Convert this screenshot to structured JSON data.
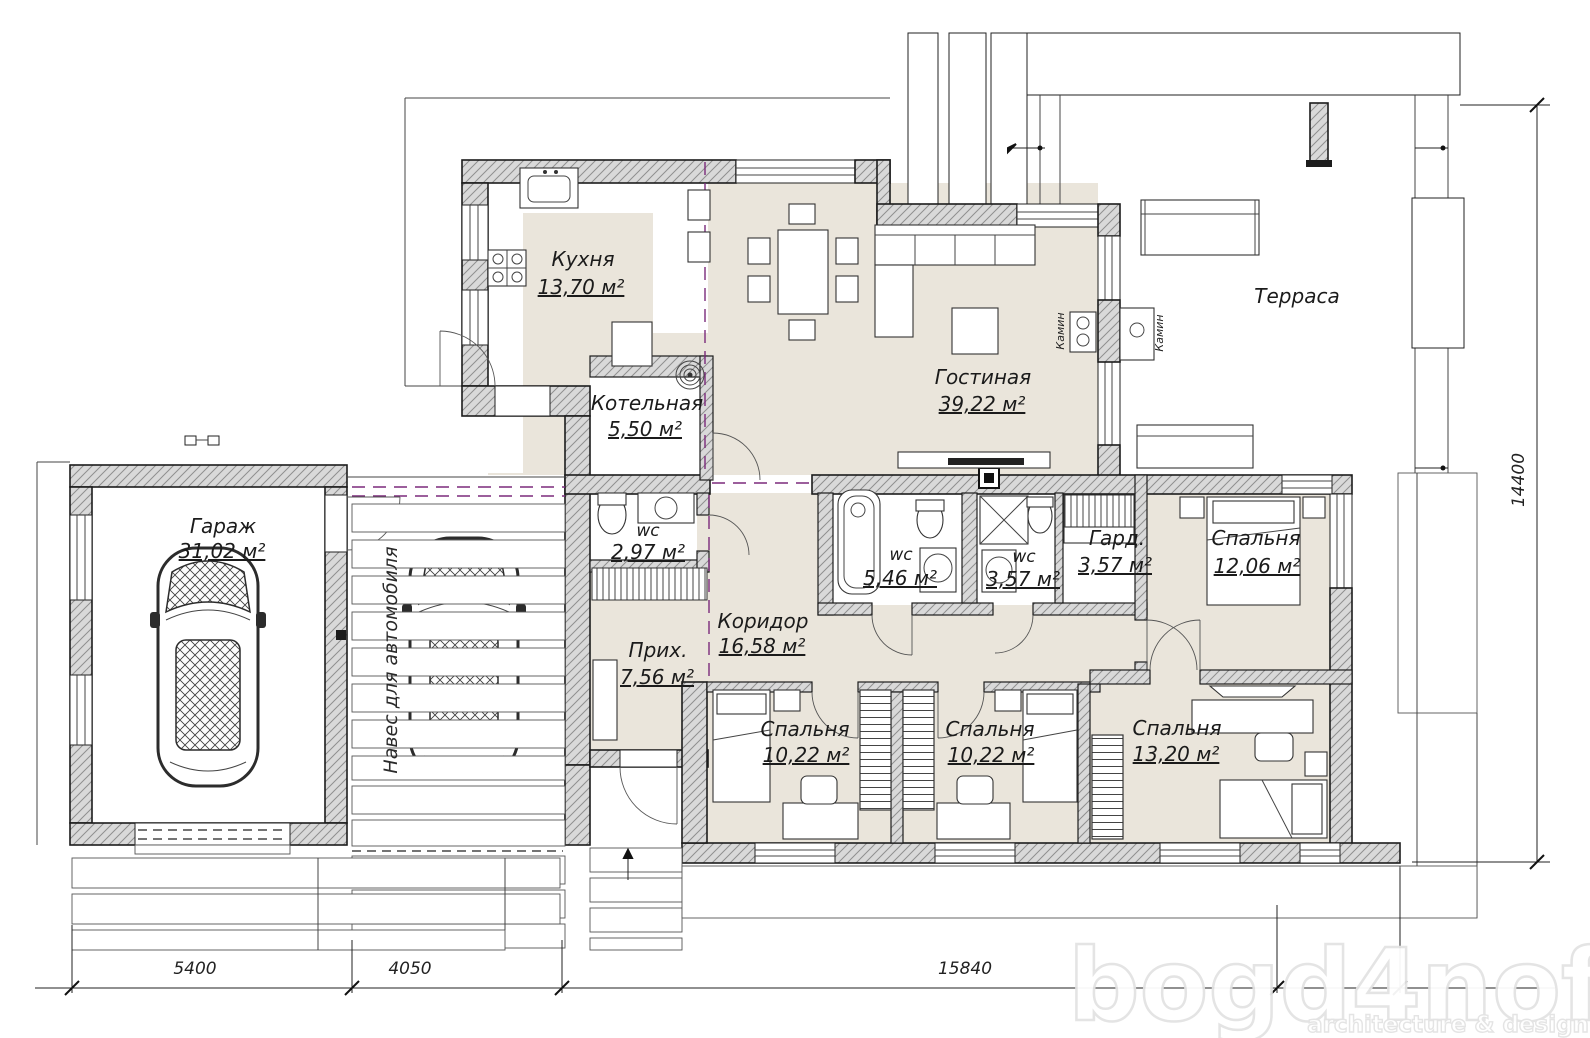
{
  "rooms": {
    "kitchen": {
      "name": "Кухня",
      "area": "13,70 м²"
    },
    "living": {
      "name": "Гостиная",
      "area": "39,22 м²"
    },
    "boiler": {
      "name": "Котельная",
      "area": "5,50 м²"
    },
    "terrace": {
      "name": "Терраса"
    },
    "garage": {
      "name": "Гараж",
      "area": "31,02 м²"
    },
    "wc_entry": {
      "name": "wc",
      "area": "2,97 м²"
    },
    "hall": {
      "name": "Прих.",
      "area": "7,56 м²"
    },
    "corridor": {
      "name": "Коридор",
      "area": "16,58 м²"
    },
    "wc_bath": {
      "name": "wc",
      "area": "5,46 м²"
    },
    "wc_shower": {
      "name": "wc",
      "area": "3,57 м²"
    },
    "wardrobe": {
      "name": "Гард.",
      "area": "3,57 м²"
    },
    "bedroom_master": {
      "name": "Спальня",
      "area": "12,06 м²"
    },
    "bedroom_1": {
      "name": "Спальня",
      "area": "10,22 м²"
    },
    "bedroom_2": {
      "name": "Спальня",
      "area": "10,22 м²"
    },
    "bedroom_3": {
      "name": "Спальня",
      "area": "13,20 м²"
    }
  },
  "annotations": {
    "carport": "Навес для автомобиля",
    "fireplace_left": "Камин",
    "fireplace_right": "Камин"
  },
  "dimensions": {
    "bottom_left": "5400",
    "bottom_mid": "4050",
    "bottom_right": "15840",
    "right": "14400"
  },
  "watermark": {
    "brand": "bogd4noff",
    "tagline": "architecture & design"
  },
  "colors": {
    "floor": "#eae5db",
    "wall_fill": "#d9d9d9",
    "accent_dashed": "#7b2a7b"
  }
}
